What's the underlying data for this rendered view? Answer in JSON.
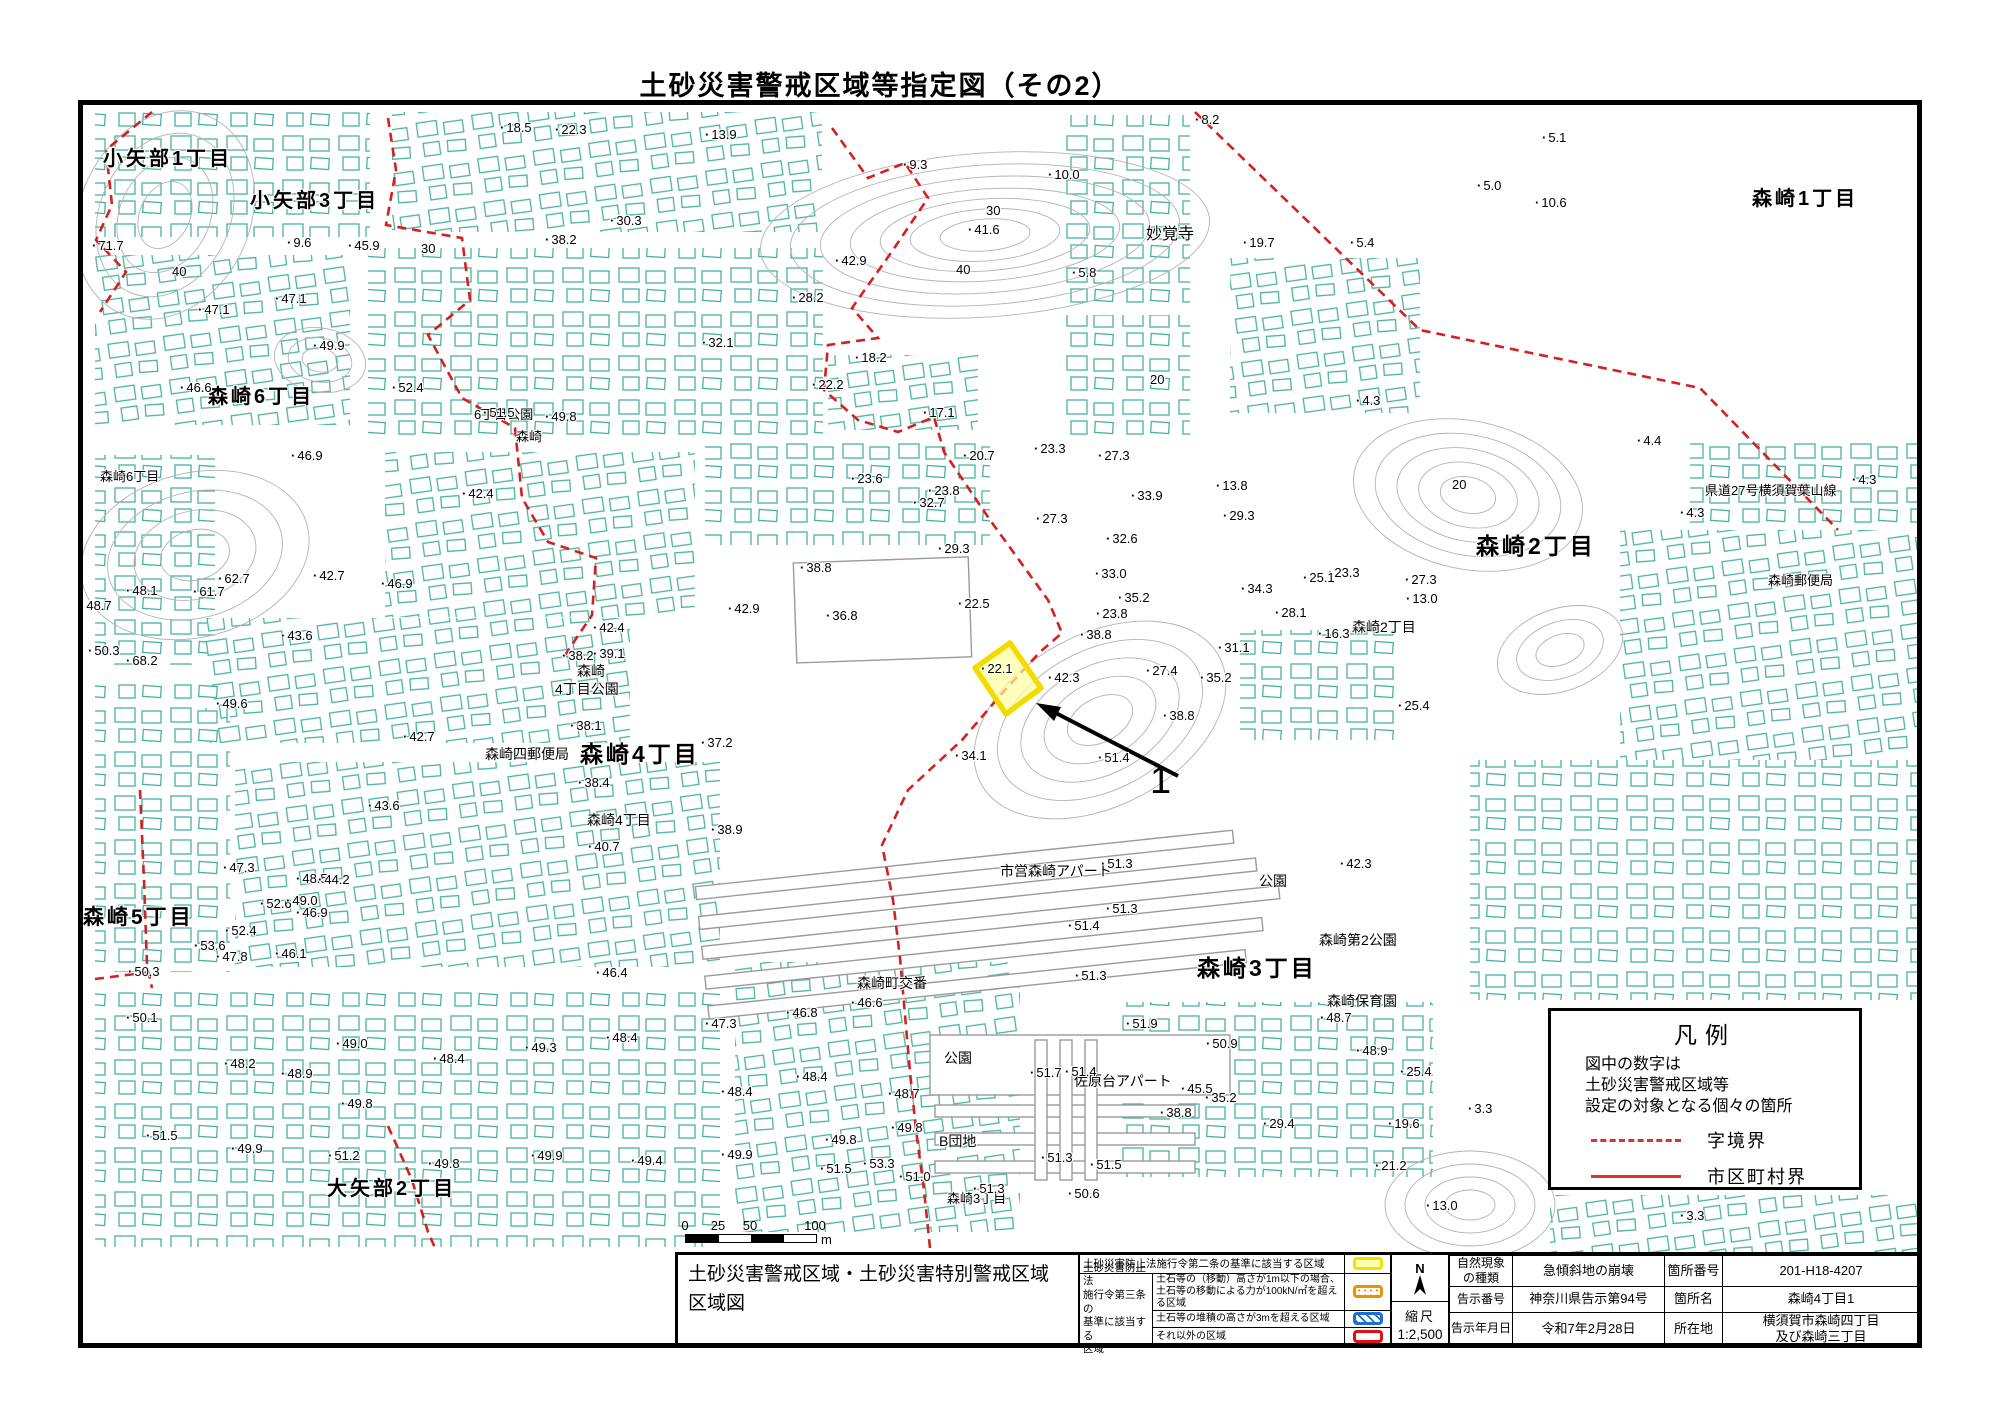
{
  "page": {
    "title": "土砂災害警戒区域等指定図（その2）"
  },
  "map": {
    "highlight": {
      "value": "22.1",
      "marker_label": "1"
    },
    "legend_box": {
      "title": "凡例",
      "note": "図中の数字は\n土砂災害警戒区域等\n設定の対象となる個々の箇所",
      "items": [
        {
          "line": "dashed",
          "label": "字境界"
        },
        {
          "line": "solid",
          "label": "市区町村界"
        }
      ],
      "line_color": "#e03131"
    },
    "scale_bar": {
      "ticks": [
        {
          "t": "0",
          "x": 2
        },
        {
          "t": "25",
          "x": 35
        },
        {
          "t": "50",
          "x": 67
        },
        {
          "t": "100",
          "x": 132
        }
      ],
      "unit": "m"
    },
    "place_labels": [
      {
        "t": "小矢部1丁目",
        "x": 103,
        "y": 148,
        "s": 20,
        "b": 1
      },
      {
        "t": "小矢部3丁目",
        "x": 250,
        "y": 190,
        "s": 20,
        "b": 1
      },
      {
        "t": "森崎1丁目",
        "x": 1752,
        "y": 188,
        "s": 20,
        "b": 1
      },
      {
        "t": "妙覚寺",
        "x": 1146,
        "y": 226,
        "s": 16,
        "b": 0
      },
      {
        "t": "森崎6丁目",
        "x": 208,
        "y": 386,
        "s": 20,
        "b": 1
      },
      {
        "t": "森崎6丁目",
        "x": 100,
        "y": 470,
        "s": 13,
        "b": 0
      },
      {
        "t": "6丁目公園",
        "x": 474,
        "y": 408,
        "s": 13,
        "b": 0
      },
      {
        "t": "森崎",
        "x": 516,
        "y": 430,
        "s": 13,
        "b": 0
      },
      {
        "t": "県道27号横須賀葉山線",
        "x": 1705,
        "y": 484,
        "s": 13,
        "b": 0
      },
      {
        "t": "森崎2丁目",
        "x": 1476,
        "y": 534,
        "s": 23,
        "b": 1
      },
      {
        "t": "森崎郵便局",
        "x": 1768,
        "y": 574,
        "s": 13,
        "b": 0
      },
      {
        "t": "森崎2丁目",
        "x": 1352,
        "y": 620,
        "s": 14,
        "b": 0
      },
      {
        "t": "森崎",
        "x": 577,
        "y": 664,
        "s": 14,
        "b": 0
      },
      {
        "t": "4丁目公園",
        "x": 555,
        "y": 682,
        "s": 14,
        "b": 0
      },
      {
        "t": "森崎四郵便局",
        "x": 485,
        "y": 747,
        "s": 14,
        "b": 0
      },
      {
        "t": "森崎4丁目",
        "x": 580,
        "y": 742,
        "s": 23,
        "b": 1
      },
      {
        "t": "森崎4丁目",
        "x": 587,
        "y": 813,
        "s": 14,
        "b": 0
      },
      {
        "t": "市営森崎アパート",
        "x": 1000,
        "y": 864,
        "s": 14,
        "b": 0
      },
      {
        "t": "公園",
        "x": 1259,
        "y": 874,
        "s": 14,
        "b": 0
      },
      {
        "t": "森崎第2公園",
        "x": 1319,
        "y": 933,
        "s": 14,
        "b": 0
      },
      {
        "t": "森崎3丁目",
        "x": 1197,
        "y": 956,
        "s": 23,
        "b": 1
      },
      {
        "t": "森崎保育園",
        "x": 1327,
        "y": 994,
        "s": 14,
        "b": 0
      },
      {
        "t": "森崎町交番",
        "x": 857,
        "y": 976,
        "s": 14,
        "b": 0
      },
      {
        "t": "公園",
        "x": 944,
        "y": 1051,
        "s": 14,
        "b": 0
      },
      {
        "t": "佐原台アパート",
        "x": 1074,
        "y": 1074,
        "s": 14,
        "b": 0
      },
      {
        "t": "B団地",
        "x": 939,
        "y": 1134,
        "s": 14,
        "b": 0
      },
      {
        "t": "森崎5丁目",
        "x": 83,
        "y": 906,
        "s": 21,
        "b": 1
      },
      {
        "t": "大矢部2丁目",
        "x": 327,
        "y": 1178,
        "s": 20,
        "b": 1
      },
      {
        "t": "森崎3丁目",
        "x": 947,
        "y": 1192,
        "s": 13,
        "b": 0
      }
    ],
    "spot_heights": [
      {
        "v": "18.5",
        "x": 500,
        "y": 120
      },
      {
        "v": "22.3",
        "x": 555,
        "y": 122
      },
      {
        "v": "13.9",
        "x": 705,
        "y": 127
      },
      {
        "v": "8.2",
        "x": 1195,
        "y": 112
      },
      {
        "v": "5.1",
        "x": 1542,
        "y": 130
      },
      {
        "v": "10.0",
        "x": 1048,
        "y": 167
      },
      {
        "v": "9.3",
        "x": 903,
        "y": 157
      },
      {
        "v": "30",
        "x": 986,
        "y": 203,
        "c": 1
      },
      {
        "v": "9.6",
        "x": 287,
        "y": 235
      },
      {
        "v": "30.3",
        "x": 610,
        "y": 213
      },
      {
        "v": "38.2",
        "x": 545,
        "y": 232
      },
      {
        "v": "45.9",
        "x": 348,
        "y": 238
      },
      {
        "v": "30",
        "x": 421,
        "y": 241,
        "c": 1
      },
      {
        "v": "71.7",
        "x": 92,
        "y": 238
      },
      {
        "v": "40",
        "x": 172,
        "y": 264,
        "c": 1
      },
      {
        "v": "19.7",
        "x": 1243,
        "y": 235
      },
      {
        "v": "5.4",
        "x": 1350,
        "y": 235
      },
      {
        "v": "5.0",
        "x": 1477,
        "y": 178
      },
      {
        "v": "10.6",
        "x": 1535,
        "y": 195
      },
      {
        "v": "41.6",
        "x": 968,
        "y": 222
      },
      {
        "v": "42.9",
        "x": 835,
        "y": 253
      },
      {
        "v": "40",
        "x": 956,
        "y": 262,
        "c": 1
      },
      {
        "v": "28.2",
        "x": 792,
        "y": 290
      },
      {
        "v": "5.8",
        "x": 1072,
        "y": 265
      },
      {
        "v": "47.1",
        "x": 198,
        "y": 302
      },
      {
        "v": "47.1",
        "x": 275,
        "y": 291
      },
      {
        "v": "49.9",
        "x": 313,
        "y": 338
      },
      {
        "v": "32.1",
        "x": 702,
        "y": 335
      },
      {
        "v": "18.2",
        "x": 855,
        "y": 350
      },
      {
        "v": "22.2",
        "x": 812,
        "y": 377
      },
      {
        "v": "46.6",
        "x": 180,
        "y": 380
      },
      {
        "v": "52.4",
        "x": 392,
        "y": 380
      },
      {
        "v": "20",
        "x": 1150,
        "y": 372,
        "c": 1
      },
      {
        "v": "4.3",
        "x": 1356,
        "y": 393
      },
      {
        "v": "4.4",
        "x": 1637,
        "y": 433
      },
      {
        "v": "4.3",
        "x": 1680,
        "y": 505
      },
      {
        "v": "4.3",
        "x": 1852,
        "y": 472
      },
      {
        "v": "20",
        "x": 1452,
        "y": 477,
        "c": 1
      },
      {
        "v": "23.3",
        "x": 1328,
        "y": 565
      },
      {
        "v": "27.3",
        "x": 1405,
        "y": 572
      },
      {
        "v": "49.8",
        "x": 545,
        "y": 409
      },
      {
        "v": "51.5",
        "x": 483,
        "y": 405
      },
      {
        "v": "42.4",
        "x": 462,
        "y": 486
      },
      {
        "v": "42.4",
        "x": 593,
        "y": 620
      },
      {
        "v": "38.2",
        "x": 562,
        "y": 648
      },
      {
        "v": "39.1",
        "x": 593,
        "y": 646
      },
      {
        "v": "38.1",
        "x": 570,
        "y": 718
      },
      {
        "v": "37.2",
        "x": 701,
        "y": 735
      },
      {
        "v": "42.7",
        "x": 403,
        "y": 729
      },
      {
        "v": "43.6",
        "x": 368,
        "y": 798
      },
      {
        "v": "38.4",
        "x": 578,
        "y": 775
      },
      {
        "v": "40.7",
        "x": 588,
        "y": 839
      },
      {
        "v": "38.9",
        "x": 711,
        "y": 822
      },
      {
        "v": "32.7",
        "x": 913,
        "y": 495
      },
      {
        "v": "29.3",
        "x": 938,
        "y": 541
      },
      {
        "v": "17.1",
        "x": 923,
        "y": 405
      },
      {
        "v": "20.7",
        "x": 963,
        "y": 448
      },
      {
        "v": "23.3",
        "x": 1034,
        "y": 441
      },
      {
        "v": "27.3",
        "x": 1098,
        "y": 448
      },
      {
        "v": "33.9",
        "x": 1131,
        "y": 488
      },
      {
        "v": "13.8",
        "x": 1216,
        "y": 478
      },
      {
        "v": "29.3",
        "x": 1223,
        "y": 508
      },
      {
        "v": "32.6",
        "x": 1106,
        "y": 531
      },
      {
        "v": "27.3",
        "x": 1036,
        "y": 511
      },
      {
        "v": "23.8",
        "x": 928,
        "y": 483
      },
      {
        "v": "23.6",
        "x": 851,
        "y": 471
      },
      {
        "v": "38.8",
        "x": 800,
        "y": 560
      },
      {
        "v": "36.8",
        "x": 826,
        "y": 608
      },
      {
        "v": "42.9",
        "x": 728,
        "y": 601
      },
      {
        "v": "22.5",
        "x": 958,
        "y": 596
      },
      {
        "v": "46.9",
        "x": 381,
        "y": 576
      },
      {
        "v": "46.9",
        "x": 291,
        "y": 448
      },
      {
        "v": "48.1",
        "x": 126,
        "y": 583
      },
      {
        "v": "61.7",
        "x": 193,
        "y": 584
      },
      {
        "v": "62.7",
        "x": 218,
        "y": 571
      },
      {
        "v": "48.7",
        "x": 80,
        "y": 598
      },
      {
        "v": "42.7",
        "x": 313,
        "y": 568
      },
      {
        "v": "50.3",
        "x": 88,
        "y": 643
      },
      {
        "v": "68.2",
        "x": 126,
        "y": 653
      },
      {
        "v": "43.6",
        "x": 281,
        "y": 628
      },
      {
        "v": "49.6",
        "x": 216,
        "y": 696
      },
      {
        "v": "22.1",
        "x": 981,
        "y": 661
      },
      {
        "v": "23.8",
        "x": 1096,
        "y": 606
      },
      {
        "v": "27.4",
        "x": 1146,
        "y": 663
      },
      {
        "v": "34.1",
        "x": 955,
        "y": 748
      },
      {
        "v": "51.4",
        "x": 1098,
        "y": 750
      },
      {
        "v": "33.0",
        "x": 1095,
        "y": 566
      },
      {
        "v": "35.2",
        "x": 1118,
        "y": 590
      },
      {
        "v": "34.3",
        "x": 1241,
        "y": 581
      },
      {
        "v": "25.1",
        "x": 1303,
        "y": 570
      },
      {
        "v": "28.1",
        "x": 1275,
        "y": 605
      },
      {
        "v": "13.0",
        "x": 1406,
        "y": 591
      },
      {
        "v": "16.3",
        "x": 1318,
        "y": 626
      },
      {
        "v": "31.1",
        "x": 1218,
        "y": 640
      },
      {
        "v": "35.2",
        "x": 1200,
        "y": 670
      },
      {
        "v": "38.8",
        "x": 1080,
        "y": 627
      },
      {
        "v": "42.3",
        "x": 1048,
        "y": 670
      },
      {
        "v": "38.8",
        "x": 1163,
        "y": 708
      },
      {
        "v": "25.4",
        "x": 1398,
        "y": 698
      },
      {
        "v": "42.3",
        "x": 1340,
        "y": 856
      },
      {
        "v": "51.3",
        "x": 1101,
        "y": 856
      },
      {
        "v": "51.3",
        "x": 1106,
        "y": 901
      },
      {
        "v": "51.4",
        "x": 1068,
        "y": 918
      },
      {
        "v": "51.3",
        "x": 1075,
        "y": 968
      },
      {
        "v": "51.9",
        "x": 1126,
        "y": 1016
      },
      {
        "v": "50.9",
        "x": 1206,
        "y": 1036
      },
      {
        "v": "48.7",
        "x": 1320,
        "y": 1010
      },
      {
        "v": "48.9",
        "x": 1356,
        "y": 1043
      },
      {
        "v": "45.5",
        "x": 1181,
        "y": 1081
      },
      {
        "v": "29.4",
        "x": 1263,
        "y": 1116
      },
      {
        "v": "19.6",
        "x": 1388,
        "y": 1116
      },
      {
        "v": "25.4",
        "x": 1400,
        "y": 1064
      },
      {
        "v": "21.2",
        "x": 1375,
        "y": 1158
      },
      {
        "v": "13.0",
        "x": 1426,
        "y": 1198
      },
      {
        "v": "3.3",
        "x": 1468,
        "y": 1101
      },
      {
        "v": "3.3",
        "x": 1680,
        "y": 1208
      },
      {
        "v": "35.2",
        "x": 1205,
        "y": 1090
      },
      {
        "v": "38.8",
        "x": 1160,
        "y": 1105
      },
      {
        "v": "46.4",
        "x": 596,
        "y": 965
      },
      {
        "v": "47.3",
        "x": 705,
        "y": 1016
      },
      {
        "v": "46.8",
        "x": 786,
        "y": 1005
      },
      {
        "v": "46.6",
        "x": 851,
        "y": 995
      },
      {
        "v": "48.4",
        "x": 606,
        "y": 1030
      },
      {
        "v": "49.3",
        "x": 525,
        "y": 1040
      },
      {
        "v": "48.4",
        "x": 796,
        "y": 1069
      },
      {
        "v": "48.4",
        "x": 721,
        "y": 1084
      },
      {
        "v": "48.7",
        "x": 888,
        "y": 1086
      },
      {
        "v": "49.8",
        "x": 825,
        "y": 1132
      },
      {
        "v": "49.8",
        "x": 891,
        "y": 1120
      },
      {
        "v": "49.9",
        "x": 721,
        "y": 1147
      },
      {
        "v": "51.0",
        "x": 899,
        "y": 1169
      },
      {
        "v": "51.7",
        "x": 1030,
        "y": 1065
      },
      {
        "v": "51.4",
        "x": 1065,
        "y": 1064
      },
      {
        "v": "51.3",
        "x": 1041,
        "y": 1150
      },
      {
        "v": "51.5",
        "x": 1090,
        "y": 1157
      },
      {
        "v": "50.1",
        "x": 126,
        "y": 1010
      },
      {
        "v": "48.2",
        "x": 224,
        "y": 1056
      },
      {
        "v": "48.9",
        "x": 281,
        "y": 1066
      },
      {
        "v": "49.0",
        "x": 336,
        "y": 1036
      },
      {
        "v": "48.4",
        "x": 433,
        "y": 1051
      },
      {
        "v": "49.8",
        "x": 341,
        "y": 1096
      },
      {
        "v": "49.9",
        "x": 231,
        "y": 1141
      },
      {
        "v": "51.5",
        "x": 146,
        "y": 1128
      },
      {
        "v": "51.2",
        "x": 328,
        "y": 1148
      },
      {
        "v": "49.8",
        "x": 428,
        "y": 1156
      },
      {
        "v": "49.9",
        "x": 531,
        "y": 1148
      },
      {
        "v": "49.4",
        "x": 631,
        "y": 1153
      },
      {
        "v": "51.5",
        "x": 820,
        "y": 1161
      },
      {
        "v": "53.3",
        "x": 863,
        "y": 1156
      },
      {
        "v": "51.3",
        "x": 973,
        "y": 1181
      },
      {
        "v": "50.6",
        "x": 1068,
        "y": 1186
      },
      {
        "v": "47.3",
        "x": 223,
        "y": 860
      },
      {
        "v": "48.5",
        "x": 296,
        "y": 871
      },
      {
        "v": "44.2",
        "x": 318,
        "y": 872
      },
      {
        "v": "52.6",
        "x": 260,
        "y": 896
      },
      {
        "v": "49.0",
        "x": 286,
        "y": 893
      },
      {
        "v": "46.9",
        "x": 296,
        "y": 905
      },
      {
        "v": "52.4",
        "x": 225,
        "y": 923
      },
      {
        "v": "53.6",
        "x": 194,
        "y": 938
      },
      {
        "v": "47.8",
        "x": 216,
        "y": 949
      },
      {
        "v": "46.1",
        "x": 275,
        "y": 946
      },
      {
        "v": "50.3",
        "x": 128,
        "y": 964
      }
    ]
  },
  "footer_table": {
    "title_lines": [
      "土砂災害警戒区域・土砂災害特別警戒区域",
      "区域図"
    ],
    "zone_legend": {
      "row1_label": "土砂災害防止法施行令第二条の基準に該当する区域",
      "row1_swatch": "yellow",
      "group_label": "土砂災害防止法\n施行令第三条の\n基準に該当する\n区域",
      "rows": [
        {
          "label": "土石等の（移動）高さが1m以下の場合、\n土石等の移動による力が100kN/㎡を超える区域",
          "swatch": "orange-dots"
        },
        {
          "label": "土石等の堆積の高さが3mを超える区域",
          "swatch": "blue-hatch"
        },
        {
          "label": "それ以外の区域",
          "swatch": "red-outline"
        }
      ]
    },
    "compass": {
      "label": "N"
    },
    "scale": {
      "label": "縮尺",
      "value": "1:2,500"
    },
    "info_rows": [
      {
        "c0": "自然現象\nの種類",
        "c1": "急傾斜地の崩壊",
        "c2": "箇所番号",
        "c3": "201-H18-4207"
      },
      {
        "c0": "告示番号",
        "c1": "神奈川県告示第94号",
        "c2": "箇所名",
        "c3": "森崎4丁目1"
      },
      {
        "c0": "告示年月日",
        "c1": "令和7年2月28日",
        "c2": "所在地",
        "c3": "横須賀市森崎四丁目\n及び森崎三丁目"
      }
    ]
  }
}
